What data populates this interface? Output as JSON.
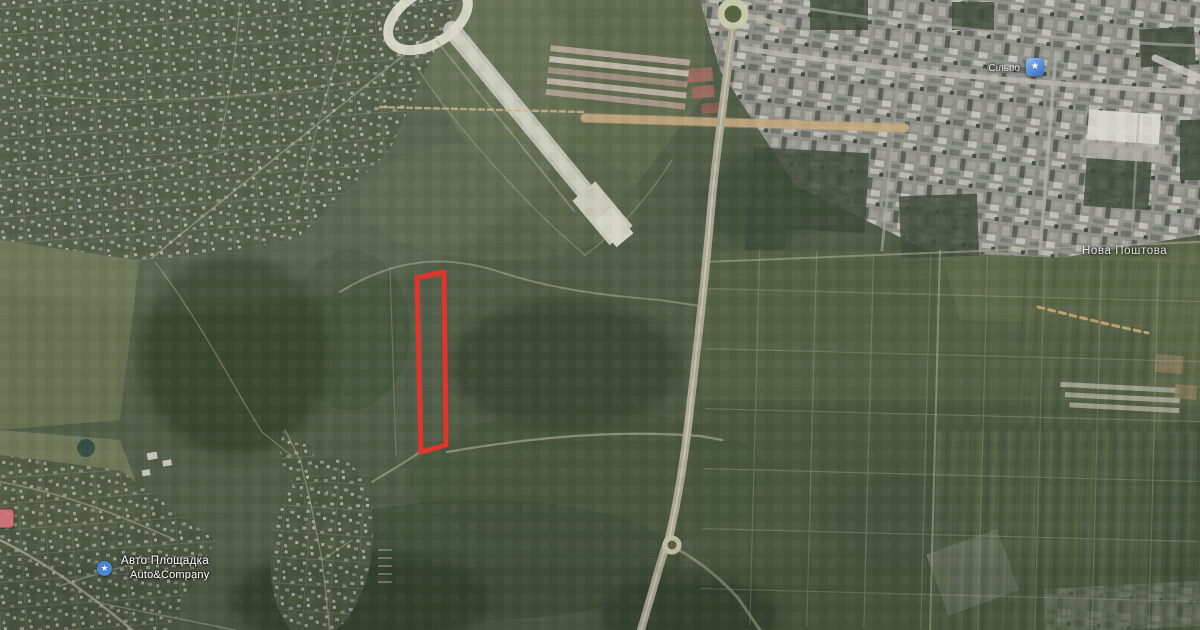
{
  "window": {
    "width": 1200,
    "height": 630,
    "view": "satellite-map"
  },
  "map": {
    "labels": {
      "supermarket": "Сільпо",
      "district": "Нова Поштова",
      "business_line1": "Авто Площадка",
      "business_line2": "Auto&Company"
    },
    "markers": {
      "supermarket_icon": "shopping-poi",
      "business_icon": "auto-service-poi",
      "edge_icon": "red-poi",
      "icon_glyph": "★"
    },
    "highlight": {
      "name": "land-parcel-outline",
      "shape": "tall-narrow-rectangle",
      "color": "#df352c"
    },
    "colors": {
      "poi_blue": "#4a86d8",
      "field_green": "#4f5b46",
      "urban_gray": "#8d8d87",
      "runway_gray": "#bdbfae",
      "trail_tan": "#c9a46e",
      "road_tan": "#a8a490"
    }
  }
}
